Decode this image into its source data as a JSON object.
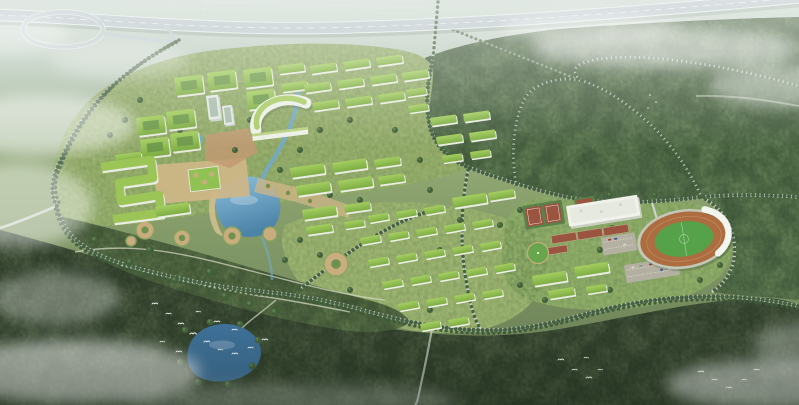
{
  "scene": {
    "description": "Aerial bird's-eye architectural rendering of a forested green-campus master plan: an elevated expressway with a cloverleaf loop ramp crosses the hazy top-left; clusters of white academic buildings with bright green roofs surround a central plaza, an arc-shaped hall, a zigzag terraced building and a blue campus lake; rows of green-roofed dormitory blocks step down-slope; at the right sit a running-track stadium with a white grandstand canopy, a white gymnasium, red tennis and sport courts and parking lots; two nested tree-lined loop roads wind through the dense surrounding forest; a forest pond, canal, drifting white mist and flocks of small white birds complete the scene.",
    "type_label": "Aerial architectural rendering",
    "features": {
      "highway": "Elevated expressway with cloverleaf interchange ramp",
      "campus_core": "Academic quarter: courtyard blocks, arc-shaped hall, zigzag terraced building, central plaza and lake",
      "dormitories": "Rows of green-roofed dormitory blocks",
      "sports": "Stadium with running track and white canopy, gymnasium, tennis and sport courts, parking lots",
      "forest": "Dense forest belt crossed by tree-lined loop roads",
      "water": "Campus lake, forest pond, canal and stream",
      "atmosphere": "Hazy horizon, drifting low mist and flocks of white birds"
    },
    "colors": {
      "sky_haze": "#c9d7ce",
      "ground_far": "#a9bda4",
      "ground_near": "#70865b",
      "forest_ne": "#5f7a52",
      "forest_ne_dark": "#3a5236",
      "forest_south": "#46573d",
      "forest_south_dark": "#2b3a27",
      "knoll": "#5a7148",
      "knoll_dark": "#394e31",
      "lawn_nw": "#98b06d",
      "lawn_dorm": "#9cb371",
      "lawn_sports": "#90ae69",
      "tree_dark": "#3f5c3a",
      "roof_green_light": "#a6d061",
      "roof_green_dark": "#7fae45",
      "facade_white": "#e9ece2",
      "water_light": "#8cc0dc",
      "water_deep": "#4c83a8",
      "pond_deep": "#3e6f96",
      "canal_blue": "#74a9c4",
      "highway_deck": "#b7c3c6",
      "road_grey": "#ccd3c9",
      "forest_road": "#b9c4b4",
      "track_red": "#ad6d40",
      "pitch_green": "#55a24a",
      "court_red": "#9a5440",
      "court_apron_green": "#59824a",
      "plaza_tan": "#cfb687",
      "plaza_brick": "#c29a73",
      "parking_grey": "#b3b0a2",
      "canopy_white": "#f3f5ef",
      "mist_white": "#ffffff"
    }
  }
}
